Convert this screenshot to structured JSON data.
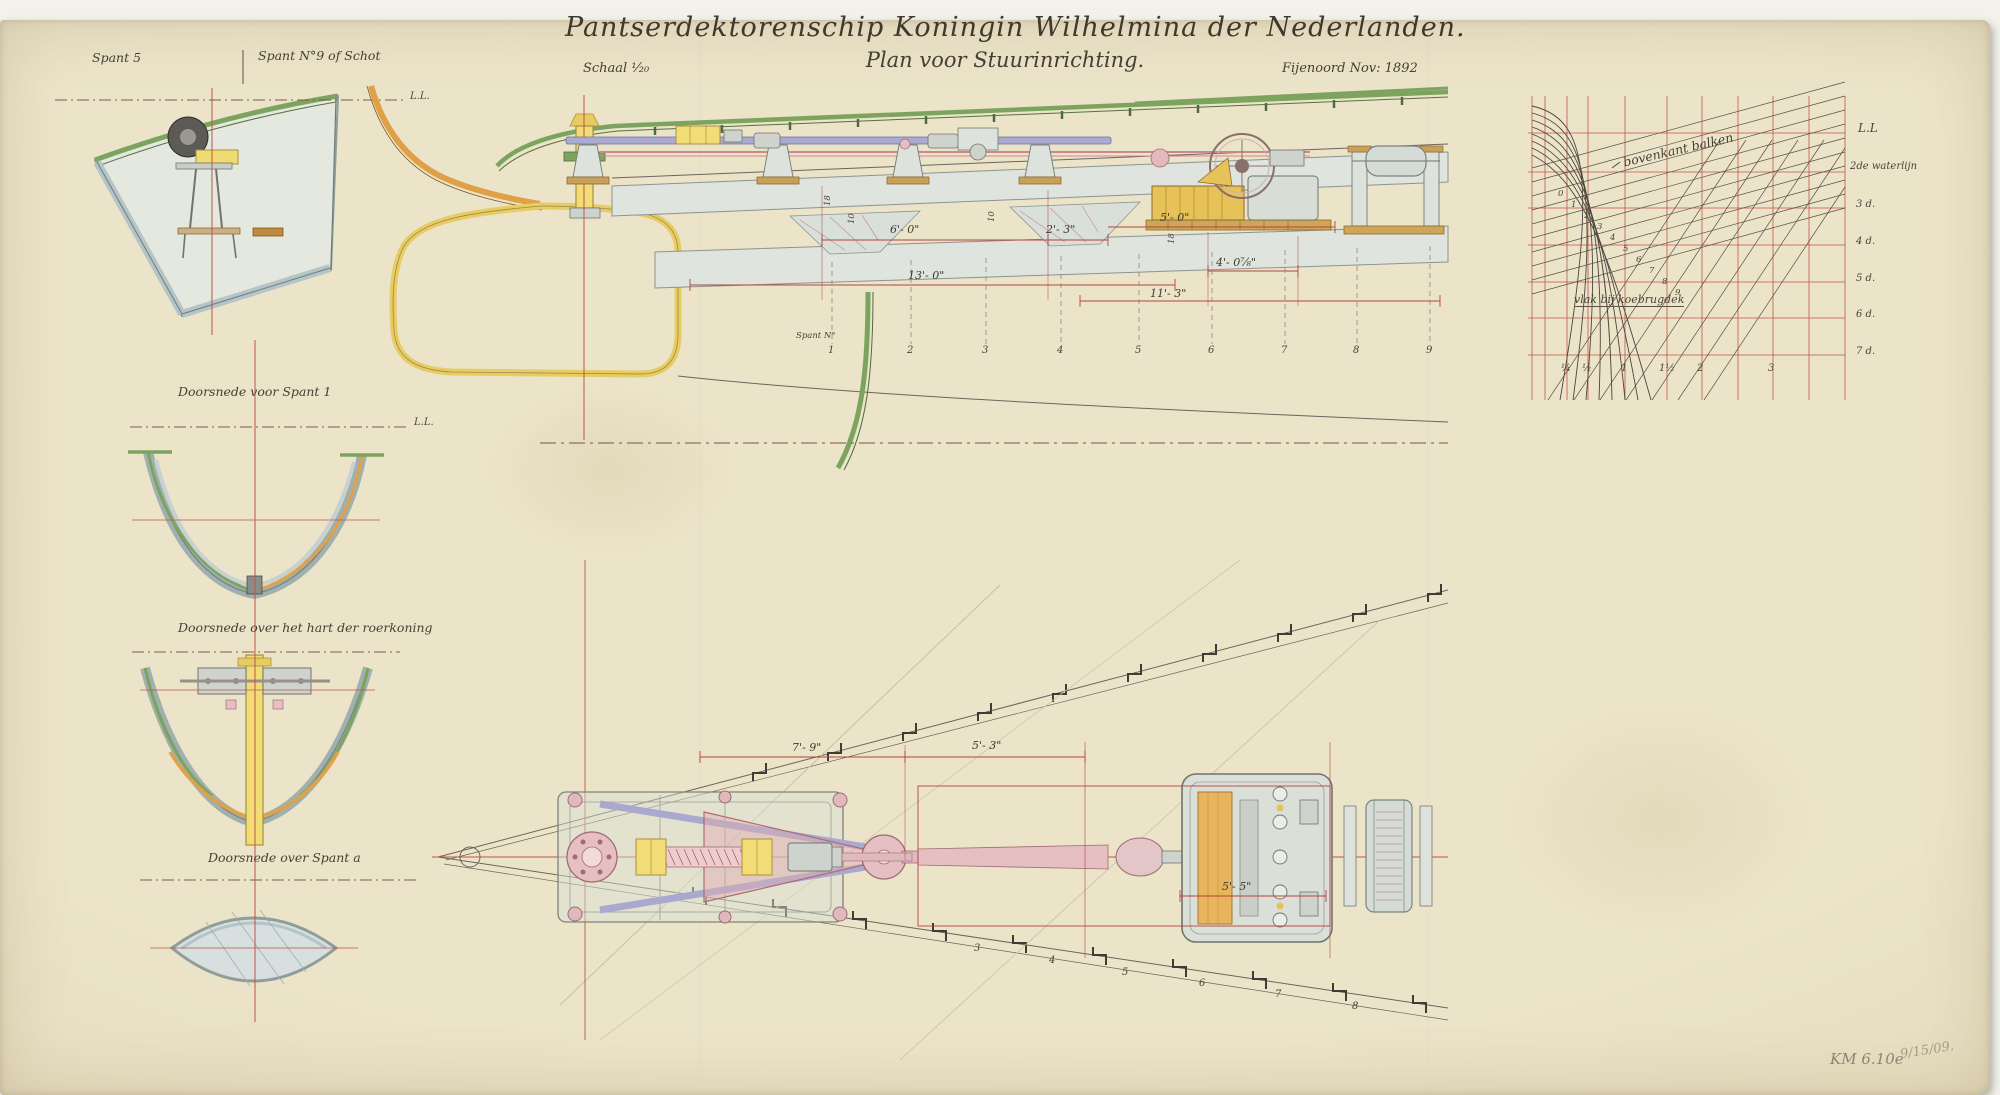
{
  "header": {
    "title": "Pantserdektorenschip Koningin Wilhelmina der Nederlanden.",
    "subtitle": "Plan voor Stuurinrichting.",
    "scale": "Schaal ¹⁄₂₀",
    "yard_date": "Fijenoord   Nov: 1892"
  },
  "left_sections": {
    "label_spant5": "Spant 5",
    "label_spant9": "Spant N°9 of Schot",
    "waterline_1": "L.L.",
    "waterline_2": "L.L.",
    "caption_spant1": "Doorsnede voor Spant 1",
    "caption_roerkoning": "Doorsnede over het hart der roerkoning",
    "caption_spant_a": "Doorsnede over Spant a"
  },
  "elevation": {
    "frame_axis_label": "Spant N°",
    "frame_numbers": [
      "1",
      "2",
      "3",
      "4",
      "5",
      "6",
      "7",
      "8",
      "9"
    ],
    "dims": {
      "d6_0": "6'- 0\"",
      "d2_3": "2'- 3\"",
      "d5_0": "5'- 0\"",
      "d13_0": "13'- 0\"",
      "d11_3": "11'- 3\"",
      "d4_0": "4'- 0⅞\"",
      "v18a": "18",
      "v10a": "10",
      "v10b": "10",
      "v18b": "18"
    }
  },
  "plan": {
    "dims": {
      "d7_9": "7'- 9\"",
      "d5_3": "5'- 3\"",
      "d5_5": "5'- 5\""
    },
    "frame_numbers_lower": [
      "3",
      "4",
      "5",
      "6",
      "7",
      "8"
    ]
  },
  "curves": {
    "waterline_labels": [
      "L.L",
      "2de waterlijn",
      "3 d.",
      "4 d.",
      "5 d.",
      "6 d.",
      "7 d."
    ],
    "x_labels": [
      "¼",
      "½",
      "1",
      "1½",
      "2",
      "3"
    ],
    "curve_numbers": [
      "0",
      "1",
      "2",
      "3",
      "4",
      "5",
      "6",
      "7",
      "8",
      "9"
    ],
    "label_bovenkant": "bovenkant balken",
    "label_koebrugdek": "vlak bij koebrugdek"
  },
  "annotations": {
    "pencil_1": "KM 6.10e",
    "pencil_2": "9/15/09."
  }
}
